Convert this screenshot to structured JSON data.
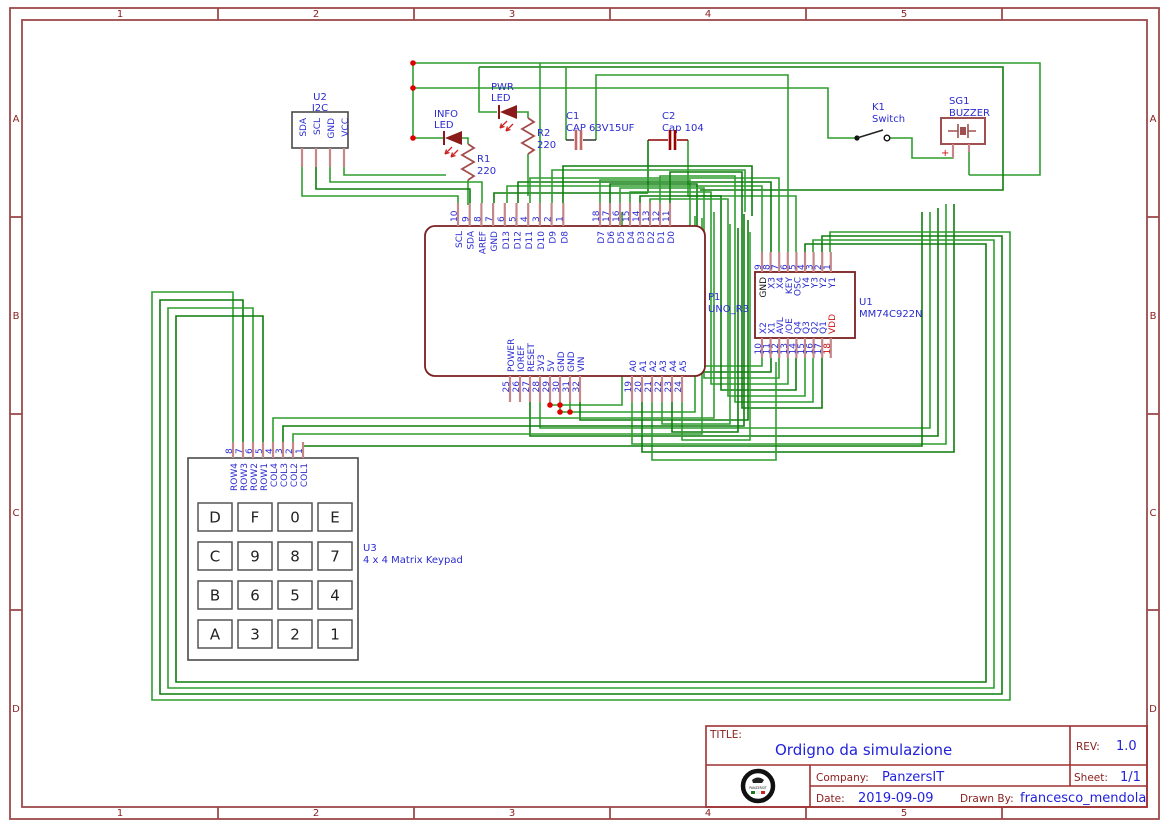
{
  "colors": {
    "wire": "#2f9e2f",
    "wire_dark": "#0d7d0d",
    "component": "#7a1f1f",
    "pin_stub": "#c48888",
    "label": "#2b2bd0",
    "frame": "#9c4a4a",
    "junction": "#e00000",
    "value_text": "#2222dd",
    "title_label": "#8b2020"
  },
  "sheet": {
    "cols": [
      "1",
      "2",
      "3",
      "4",
      "5"
    ],
    "rows": [
      "A",
      "B",
      "C",
      "D"
    ]
  },
  "title_block": {
    "title_label": "TITLE:",
    "title": "Ordigno da simulazione",
    "rev_label": "REV:",
    "rev": "1.0",
    "company_label": "Company:",
    "company": "PanzersIT",
    "sheet_label": "Sheet:",
    "sheet": "1/1",
    "date_label": "Date:",
    "date": "2019-09-09",
    "drawn_by_label": "Drawn By:",
    "drawn_by": "francesco_mendola",
    "logo_text": "PANZERSIT"
  },
  "components": {
    "u2": {
      "ref": "U2",
      "value": "I2C",
      "pins": [
        {
          "name": "SDA"
        },
        {
          "name": "SCL"
        },
        {
          "name": "GND"
        },
        {
          "name": "VCC"
        }
      ]
    },
    "info_led": {
      "line1": "INFO",
      "line2": "LED"
    },
    "pwr_led": {
      "line1": "PWR",
      "line2": "LED"
    },
    "r1": {
      "ref": "R1",
      "value": "220"
    },
    "r2": {
      "ref": "R2",
      "value": "220"
    },
    "c1": {
      "ref": "C1",
      "value": "CAP 63V15UF"
    },
    "c2": {
      "ref": "C2",
      "value": "Cap 104"
    },
    "k1": {
      "ref": "K1",
      "value": "Switch"
    },
    "sg1": {
      "ref": "SG1",
      "value": "BUZZER",
      "plus": "+"
    },
    "uno": {
      "ref": "P1",
      "value": "UNO_R3",
      "top_left": [
        {
          "num": "10",
          "name": "SCL"
        },
        {
          "num": "9",
          "name": "SDA"
        },
        {
          "num": "8",
          "name": "AREF"
        },
        {
          "num": "7",
          "name": "GND"
        },
        {
          "num": "6",
          "name": "D13"
        },
        {
          "num": "5",
          "name": "D12"
        },
        {
          "num": "4",
          "name": "D11"
        },
        {
          "num": "3",
          "name": "D10"
        },
        {
          "num": "2",
          "name": "D9"
        },
        {
          "num": "1",
          "name": "D8"
        }
      ],
      "top_right": [
        {
          "num": "18",
          "name": "D7"
        },
        {
          "num": "17",
          "name": "D6"
        },
        {
          "num": "16",
          "name": "D5"
        },
        {
          "num": "15",
          "name": "D4"
        },
        {
          "num": "14",
          "name": "D3"
        },
        {
          "num": "13",
          "name": "D2"
        },
        {
          "num": "12",
          "name": "D1"
        },
        {
          "num": "11",
          "name": "D0"
        }
      ],
      "bottom_left": [
        {
          "num": "25",
          "name": "POWER"
        },
        {
          "num": "26",
          "name": "IOREF"
        },
        {
          "num": "27",
          "name": "RESET"
        },
        {
          "num": "28",
          "name": "3V3"
        },
        {
          "num": "29",
          "name": "5V"
        },
        {
          "num": "30",
          "name": "GND"
        },
        {
          "num": "31",
          "name": "GND"
        },
        {
          "num": "32",
          "name": "VIN"
        }
      ],
      "bottom_right": [
        {
          "num": "19",
          "name": "A0"
        },
        {
          "num": "20",
          "name": "A1"
        },
        {
          "num": "21",
          "name": "A2"
        },
        {
          "num": "22",
          "name": "A3"
        },
        {
          "num": "23",
          "name": "A4"
        },
        {
          "num": "24",
          "name": "A5"
        }
      ]
    },
    "u1": {
      "ref": "U1",
      "value": "MM74C922N",
      "top": [
        {
          "num": "9",
          "name": "GND",
          "nameColor": "#111111"
        },
        {
          "num": "8",
          "name": "X3"
        },
        {
          "num": "7",
          "name": "X4"
        },
        {
          "num": "6",
          "name": "KEY"
        },
        {
          "num": "5",
          "name": "OSC"
        },
        {
          "num": "4",
          "name": "Y4"
        },
        {
          "num": "3",
          "name": "Y3"
        },
        {
          "num": "2",
          "name": "Y2"
        },
        {
          "num": "1",
          "name": "Y1"
        }
      ],
      "bottom": [
        {
          "num": "10",
          "name": "X2"
        },
        {
          "num": "11",
          "name": "X1"
        },
        {
          "num": "12",
          "name": "AVL"
        },
        {
          "num": "13",
          "name": "/OE"
        },
        {
          "num": "14",
          "name": "Q4"
        },
        {
          "num": "15",
          "name": "Q3"
        },
        {
          "num": "16",
          "name": "Q2"
        },
        {
          "num": "17",
          "name": "Q1"
        },
        {
          "num": "18",
          "name": "VDD",
          "nameColor": "#cc1111",
          "numColor": "#cc1111"
        }
      ]
    },
    "u3": {
      "ref": "U3",
      "value": "4 x 4 Matrix Keypad",
      "pins": [
        {
          "num": "8",
          "name": "ROW4"
        },
        {
          "num": "7",
          "name": "ROW3"
        },
        {
          "num": "6",
          "name": "ROW2"
        },
        {
          "num": "5",
          "name": "ROW1"
        },
        {
          "num": "4",
          "name": "COL4"
        },
        {
          "num": "3",
          "name": "COL3"
        },
        {
          "num": "2",
          "name": "COL2"
        },
        {
          "num": "1",
          "name": "COL1"
        }
      ],
      "keys": [
        [
          "D",
          "F",
          "0",
          "E"
        ],
        [
          "C",
          "9",
          "8",
          "7"
        ],
        [
          "B",
          "6",
          "5",
          "4"
        ],
        [
          "A",
          "3",
          "2",
          "1"
        ]
      ]
    }
  }
}
